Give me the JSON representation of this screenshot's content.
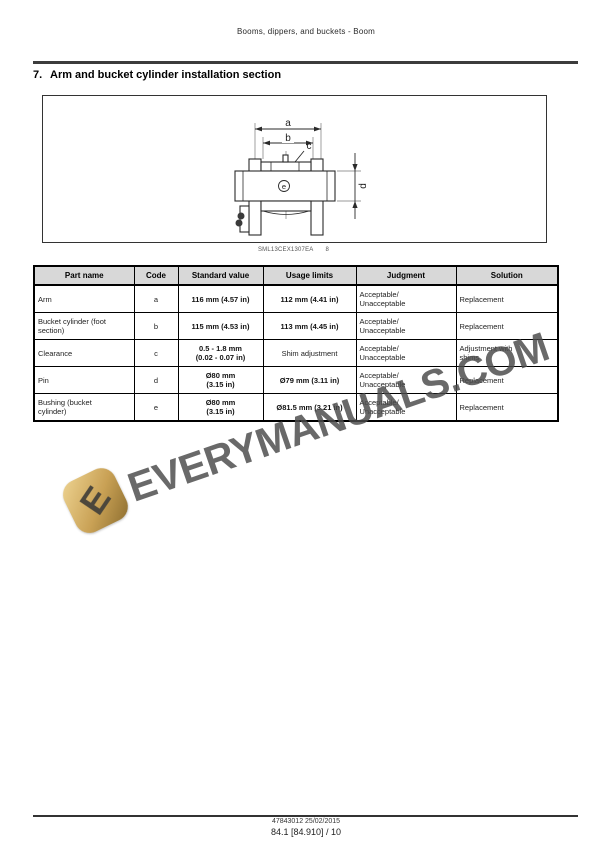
{
  "doc": {
    "header_text": "Booms, dippers, and buckets - Boom",
    "section": {
      "number": "7.",
      "title": "Arm and bucket cylinder installation section"
    },
    "figure": {
      "caption_code": "SML13CEX1307EA",
      "caption_num": "8",
      "labels": {
        "a": "a",
        "b": "b",
        "c": "c",
        "d": "d",
        "e": "e"
      }
    },
    "table": {
      "columns": [
        "Part name",
        "Code",
        "Standard value",
        "Usage limits",
        "Judgment",
        "Solution"
      ],
      "rows": [
        {
          "part": "Arm",
          "code": "a",
          "standard": "116 mm (4.57 in)",
          "usage": "112 mm (4.41 in)",
          "judgment": "Acceptable/\nUnacceptable",
          "solution": "Replacement"
        },
        {
          "part": "Bucket cylinder (foot\nsection)",
          "code": "b",
          "standard": "115 mm (4.53 in)",
          "usage": "113 mm (4.45 in)",
          "judgment": "Acceptable/\nUnacceptable",
          "solution": "Replacement"
        },
        {
          "part": "Clearance",
          "code": "c",
          "standard": "0.5 - 1.8 mm\n(0.02 - 0.07 in)",
          "usage": "Shim adjustment",
          "judgment": "Acceptable/\nUnacceptable",
          "solution": "Adjustment with\nshims"
        },
        {
          "part": "Pin",
          "code": "d",
          "standard": "Ø80 mm\n(3.15 in)",
          "usage": "Ø79 mm (3.11 in)",
          "judgment": "Acceptable/\nUnacceptable",
          "solution": "Replacement"
        },
        {
          "part": "Bushing (bucket\ncylinder)",
          "code": "e",
          "standard": "Ø80 mm\n(3.15 in)",
          "usage": "Ø81.5 mm (3.21 in)",
          "judgment": "Acceptable/\nUnacceptable",
          "solution": "Replacement"
        }
      ]
    },
    "watermark": {
      "text": "EVERYMANUALS.COM",
      "logo_letter": "E",
      "text_color": "#4a4a4a",
      "logo_gold": "#c9a155"
    },
    "footer": {
      "line1": "47843012 25/02/2015",
      "line2": "84.1 [84.910] / 10"
    },
    "colors": {
      "table_header_bg": "#d8d8d8",
      "rule": "#3c3c3c"
    }
  }
}
